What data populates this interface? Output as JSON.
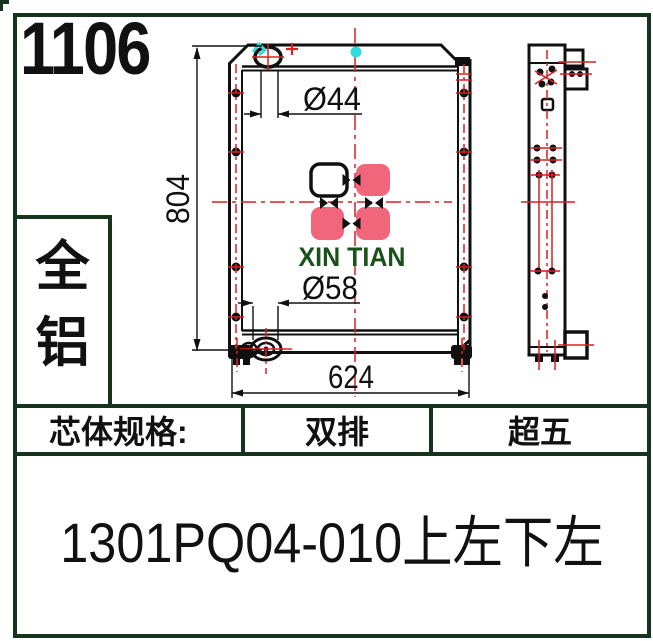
{
  "header": {
    "number": "1106"
  },
  "material_box": {
    "line1": "全",
    "line2": "铝"
  },
  "drawing": {
    "dim_top_diameter": "Ø44",
    "dim_height": "804",
    "dim_bottom_diameter": "Ø58",
    "dim_width": "624",
    "logo_text": "XIN TIAN",
    "colors": {
      "frame_green": "#16341c",
      "logo_green": "#1a511a",
      "accent_pink": "#f2667c",
      "centerline_red": "#d92121",
      "marker_cyan": "#35dcdc"
    }
  },
  "spec_table": {
    "label": "芯体规格:",
    "col1": "双排",
    "col2": "超五"
  },
  "part_number": "1301PQ04-010上左下左"
}
